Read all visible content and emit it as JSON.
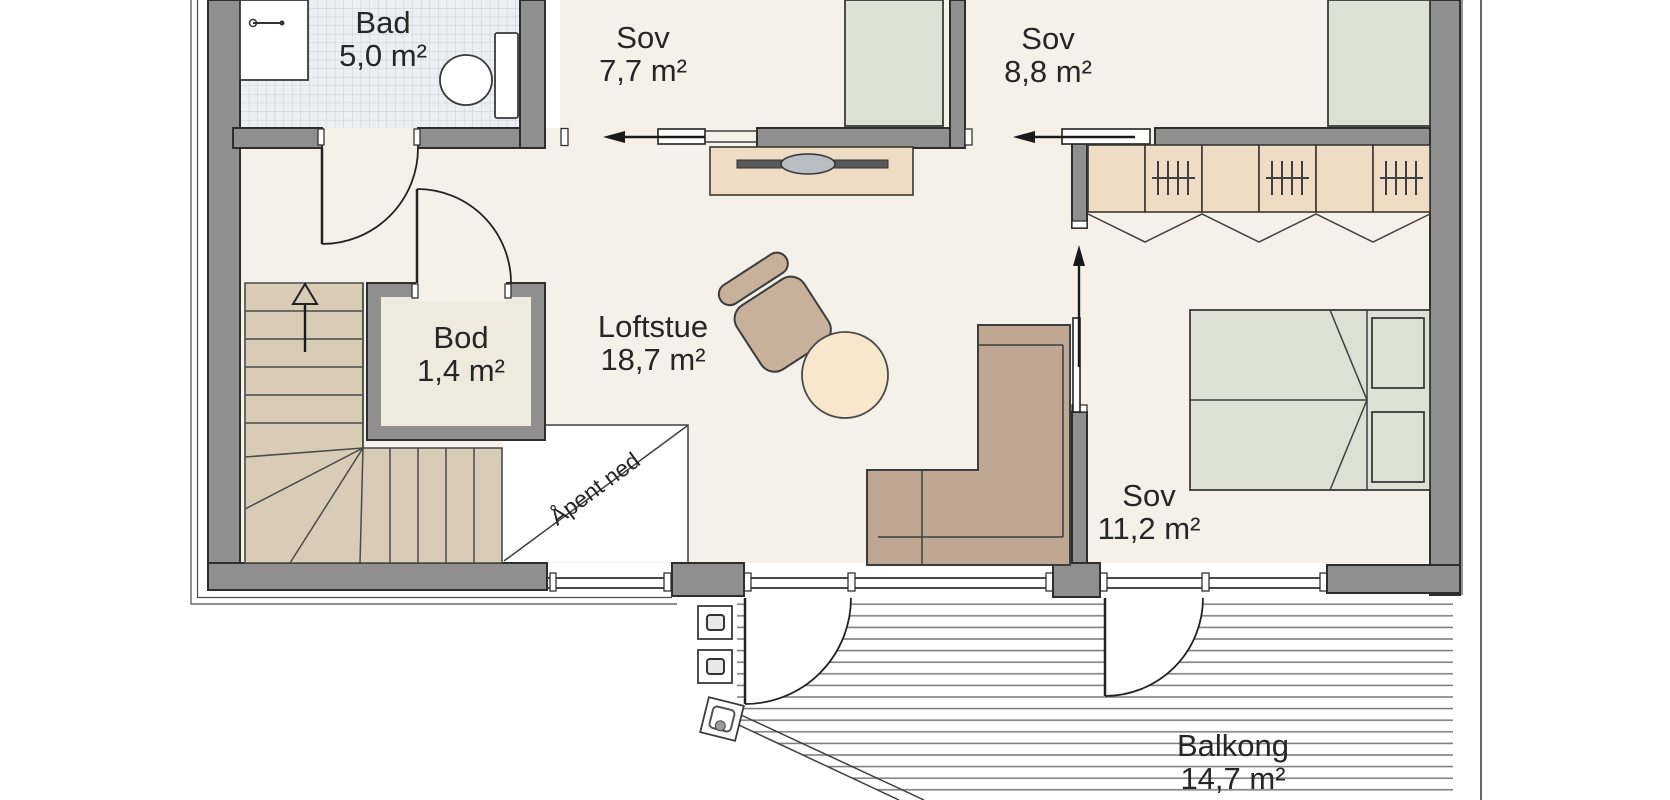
{
  "plan": {
    "title": "Loft floor plan",
    "rooms": {
      "bad": {
        "name": "Bad",
        "area": "5,0 m²"
      },
      "sov1": {
        "name": "Sov",
        "area": "7,7 m²"
      },
      "sov2": {
        "name": "Sov",
        "area": "8,8 m²"
      },
      "bod": {
        "name": "Bod",
        "area": "1,4 m²"
      },
      "loftstue": {
        "name": "Loftstue",
        "area": "18,7 m²"
      },
      "sov3": {
        "name": "Sov",
        "area": "11,2 m²"
      },
      "balkong": {
        "name": "Balkong",
        "area": "14,7 m²"
      }
    },
    "annotations": {
      "open_below": "Åpent ned"
    },
    "palette": {
      "wall": "#8f8f8f",
      "wall_outline": "#2e2e2e",
      "floor": "#f5f1e9",
      "bod_floor": "#f0e9dd",
      "stairs": "#d9ccb6",
      "wood": "#eeddc4",
      "wood_outline": "#3c3830",
      "bed": "#dde1d3",
      "sofa": "#bfa791",
      "armchair": "#c8b19b",
      "table": "#f7e7cd",
      "tile": "#edeff4",
      "tile_line": "#c6ccd8",
      "deck_line": "#787878",
      "text": "#262626",
      "white": "#ffffff"
    }
  }
}
